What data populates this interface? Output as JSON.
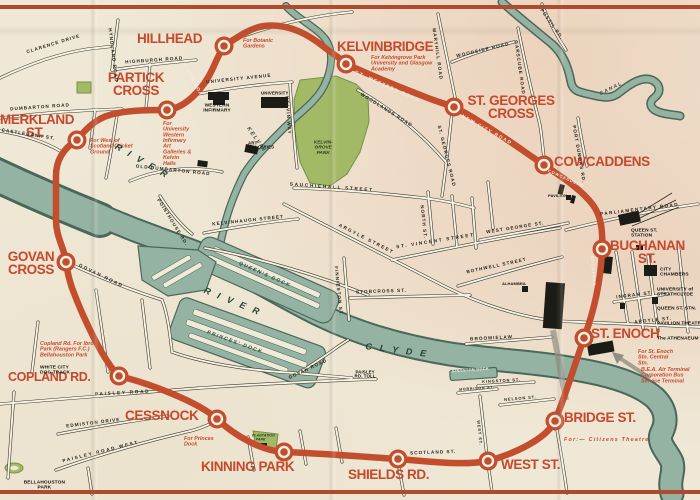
{
  "line": {
    "color": "#c24e2e"
  },
  "stations": [
    {
      "name": "HILLHEAD",
      "note": "For Botanic Gardens"
    },
    {
      "name": "KELVINBRIDGE",
      "note": "For Kelvingrove Park University and Glasgow Academy"
    },
    {
      "name": "ST. GEORGES CROSS"
    },
    {
      "name": "COWCADDENS"
    },
    {
      "name": "BUCHANAN ST."
    },
    {
      "name": "ST. ENOCH",
      "note": "For St. Enoch Stn. Central Stn.",
      "note2": "B.E.A. Air Terminal Corporation Bus Service Terminal"
    },
    {
      "name": "BRIDGE ST.",
      "note": "For:— Citizens Theatre"
    },
    {
      "name": "WEST ST."
    },
    {
      "name": "SHIELDS RD."
    },
    {
      "name": "KINNING PARK"
    },
    {
      "name": "CESSNOCK",
      "note": "For Princes Dock"
    },
    {
      "name": "COPLAND RD.",
      "note": "Copland Rd. For Ibrox Park (Rangers F.C.) Bellahouston Park",
      "note2": "WHITE CITY DOG TRACK"
    },
    {
      "name": "GOVAN CROSS"
    },
    {
      "name": "MERKLAND ST.",
      "note": "For West of Scotland Cricket Ground"
    },
    {
      "name": "PARTICK CROSS",
      "note": "For University Western Infirmary Art Galleries & Kelvin Halls"
    }
  ],
  "roads": {
    "clarence": "CLARENCE DRIVE",
    "hyndland": "HYNDLAND ROAD",
    "highburgh": "HIGHBURGH ROAD",
    "university_ave": "UNIVERSITY AVENUE",
    "dumbarton": "DUMBARTON ROAD",
    "castlebank": "CASTLEBANK ST.",
    "old_dumbarton": "OLD DUMBARTON ROAD",
    "pointhouse": "POINTHOUSE RD.",
    "kelvinhaugh": "KELVINHAUGH STREET",
    "kelvin_way": "KELVIN WAY",
    "sauchiehall": "SAUCHIEHALL STREET",
    "argyle_street": "ARGYLE STREET",
    "st_vincent": "ST. VINCENT STREET",
    "west_george": "WEST GEORGE ST.",
    "bothwell": "BOTHWELL STREET",
    "stobcross": "STOBCROSS ST.",
    "finnieston": "FINNIESTON ST.",
    "north_st": "NORTH ST.",
    "st_georges_rd": "ST. GEORGES ROAD",
    "woodlands": "WOODLANDS ROAD",
    "maryhill": "MARYHILL ROAD",
    "woodside": "WOODSIDE ROAD",
    "garscube": "GARSCUBE ROAD",
    "possil": "POSSIL RD.",
    "port_dundas": "PORT DUNDAS RD.",
    "parliamentary": "PARLIAMENTARY ROAD",
    "ingram": "INGRAM ST.",
    "argyle_st2": "ARGYLE ST.",
    "broomielaw": "BROOMIELAW",
    "paisley_road": "PAISLEY ROAD",
    "kingston_st": "KINGSTON ST.",
    "nelson": "NELSON ST.",
    "morrison": "MORRISON ST.",
    "west_st_rd": "WEST ST.",
    "scotland": "SCOTLAND ST.",
    "govan_road": "GOVAN ROAD",
    "govan_road2": "GOVAN ROAD",
    "paisley_west": "PAISLEY ROAD WEST",
    "edmiston": "EDMISTON DRIVE",
    "byres": "BYRES ROAD",
    "gt_western": "GT. WESTERN ROAD",
    "new_city": "NEW CITY ROAD",
    "cowcaddens_rd": "COWCADDENS",
    "buchanan_rd": "BUCHANAN"
  },
  "water": {
    "river": "RIVER",
    "clyde": "CLYDE",
    "kelvin": "KELVIN",
    "canal": "CANAL",
    "queens_dock": "QUEEN'S DOCK",
    "princes_dock": "PRINCES' DOCK",
    "kingston_dock": "KINGSTON DOCK"
  },
  "parks": {
    "kelvingrove": "KELVIN- GROVE PARK",
    "bellahouston": "BELLAHOUSTON PARK",
    "plantation": "PLANTATION PARK"
  },
  "landmarks": {
    "western_infirmary": "WESTERN INFIRMARY",
    "university": "UNIVERSITY",
    "art_galleries": "ART GALLERIES",
    "queen_st_station": "QUEEN ST. STATION",
    "city_chambers": "CITY CHAMBERS",
    "strathclyde": "UNIVERSITY of STRATHCLYDE",
    "queen_st_stn": "QUEEN ST. STN.",
    "pavilion_theatre": "PAVILION THEATRE",
    "athenaeum": "The ATHENAEUM",
    "alhambra": "ALHAMBRA",
    "pavilion": "PAVILION",
    "paisley_toll": "PAISLEY RD. TOLL"
  }
}
